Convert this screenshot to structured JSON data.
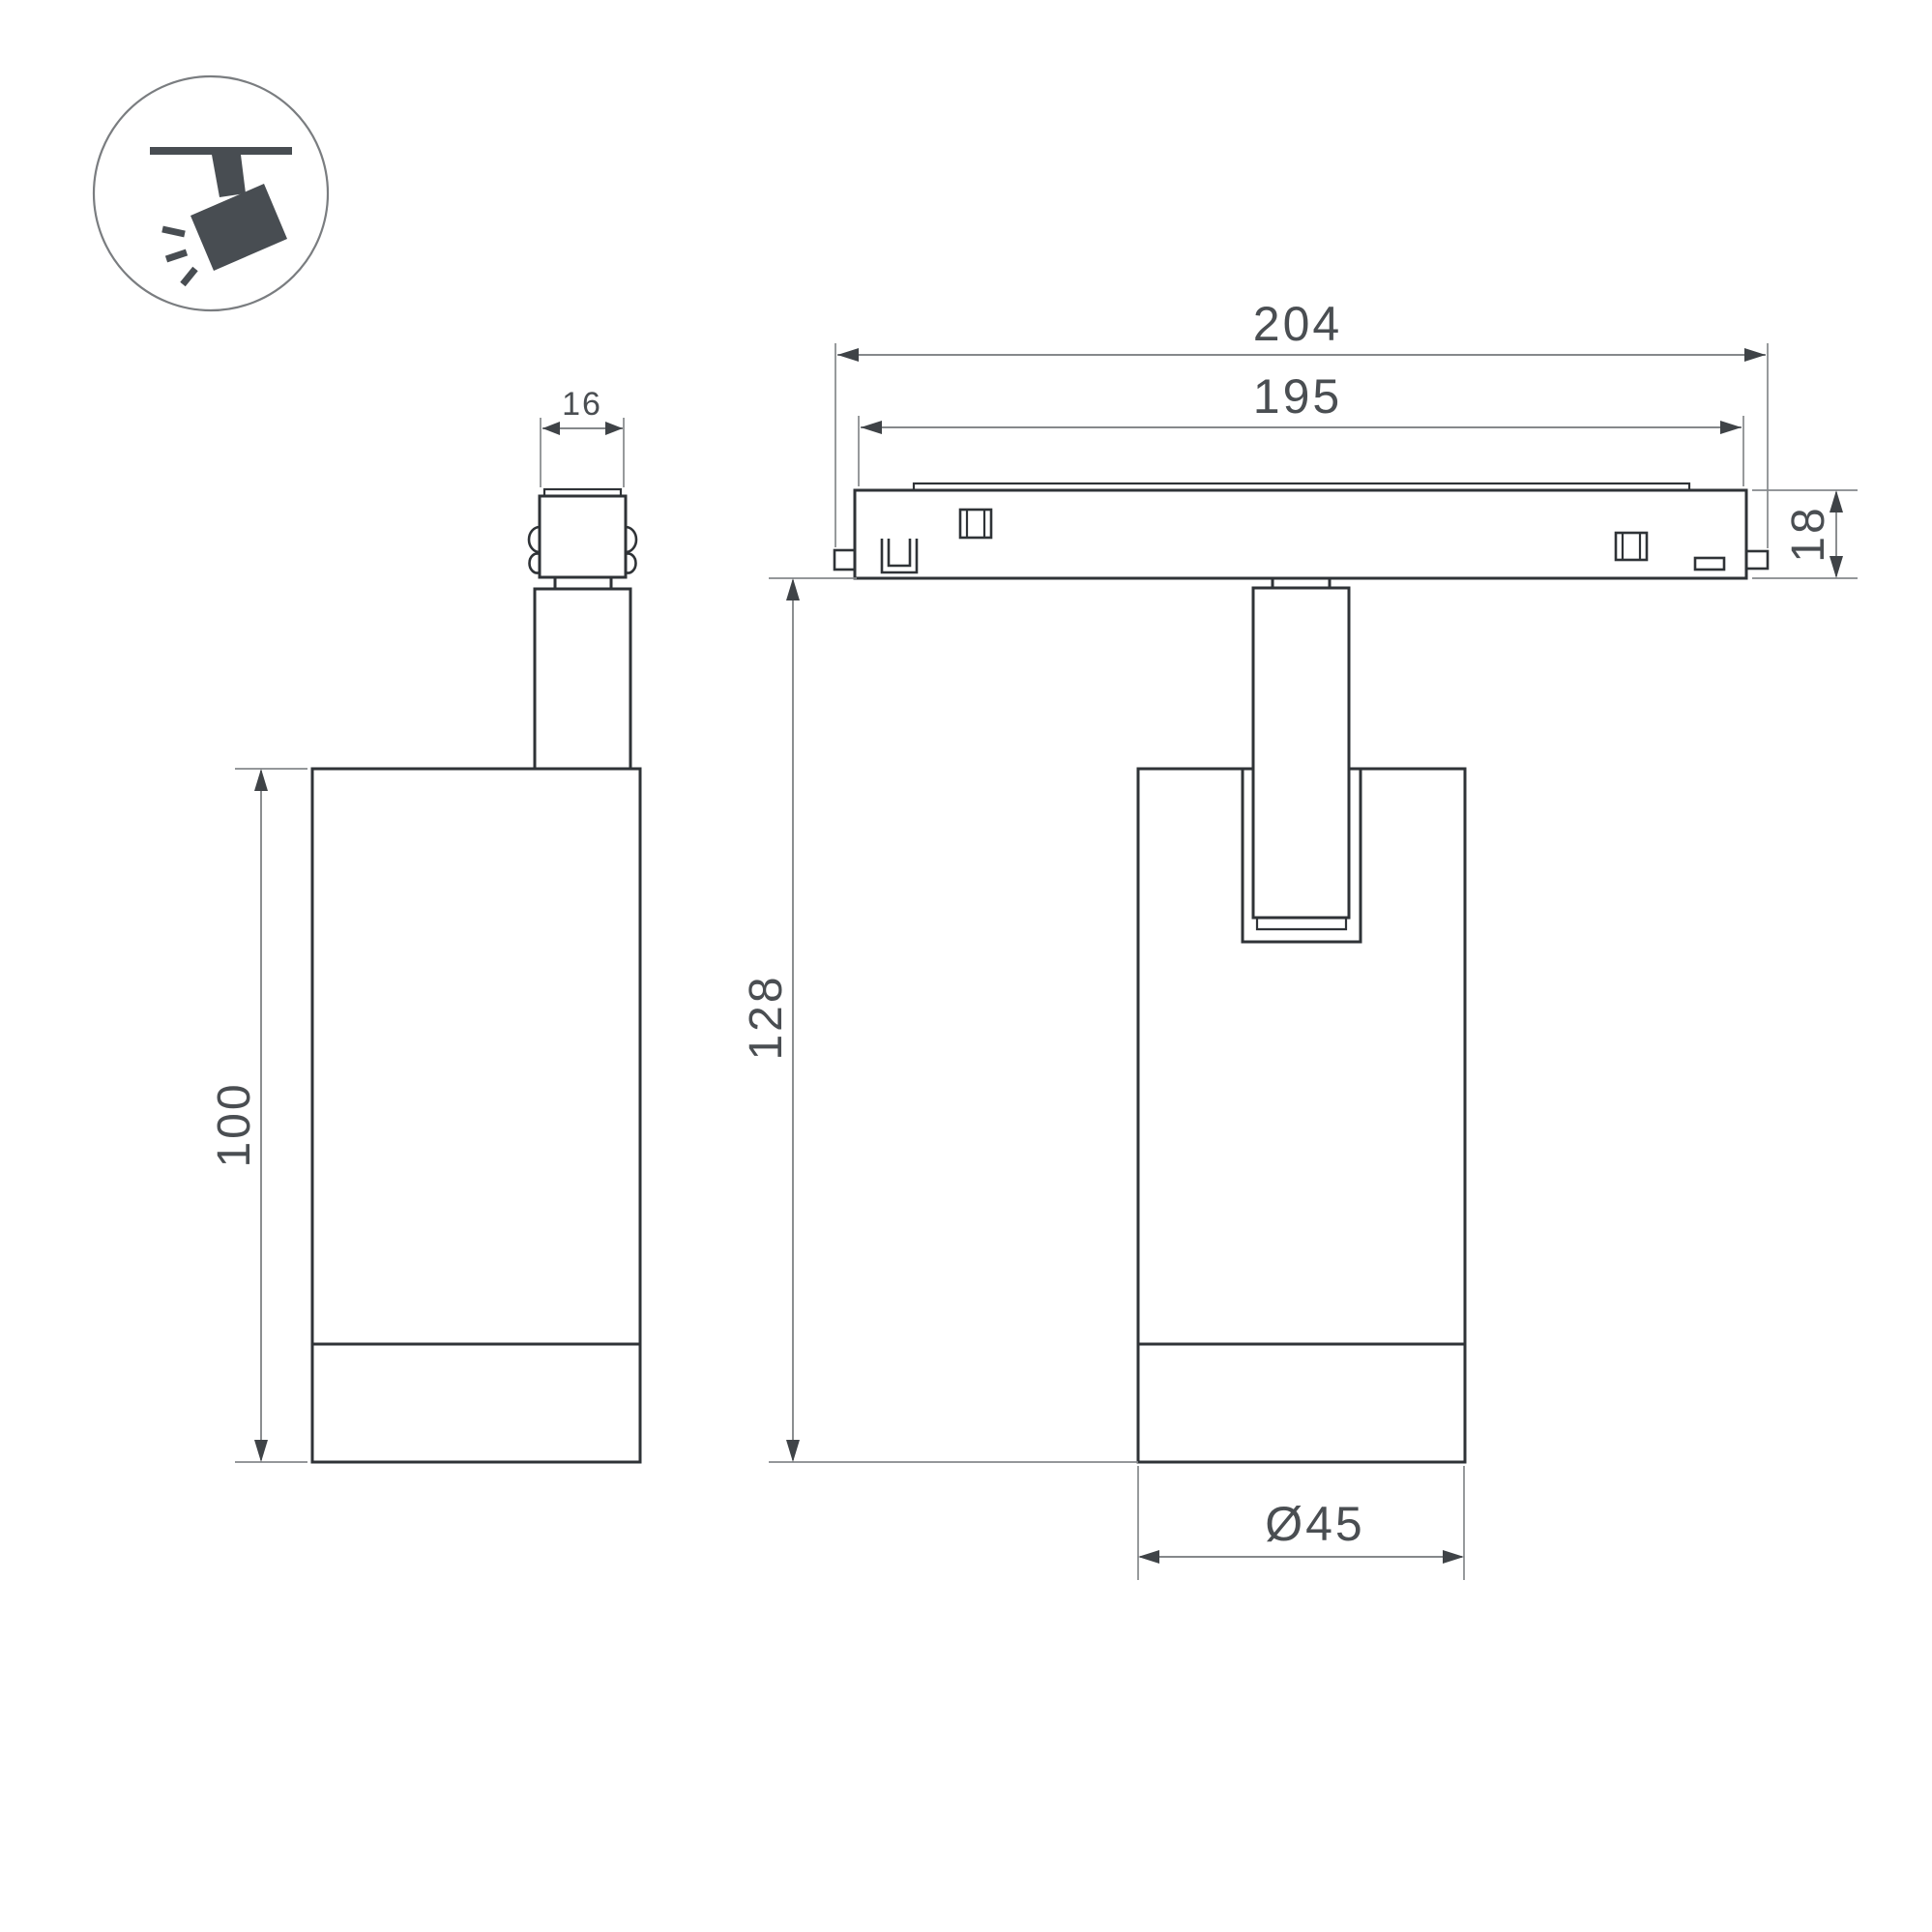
{
  "icon": {
    "symbol": "track-spotlight"
  },
  "dimensions": {
    "adapter_width": "16",
    "body_height": "100",
    "track_outer_length": "204",
    "track_inner_length": "195",
    "track_height": "18",
    "overall_height": "128",
    "body_diameter": "Ø45"
  },
  "colors": {
    "background": "#ffffff",
    "outline": "#2f3337",
    "dim_line": "#85888b",
    "arrow": "#3f4347",
    "text": "#4a4e52",
    "icon": "#484d52"
  }
}
